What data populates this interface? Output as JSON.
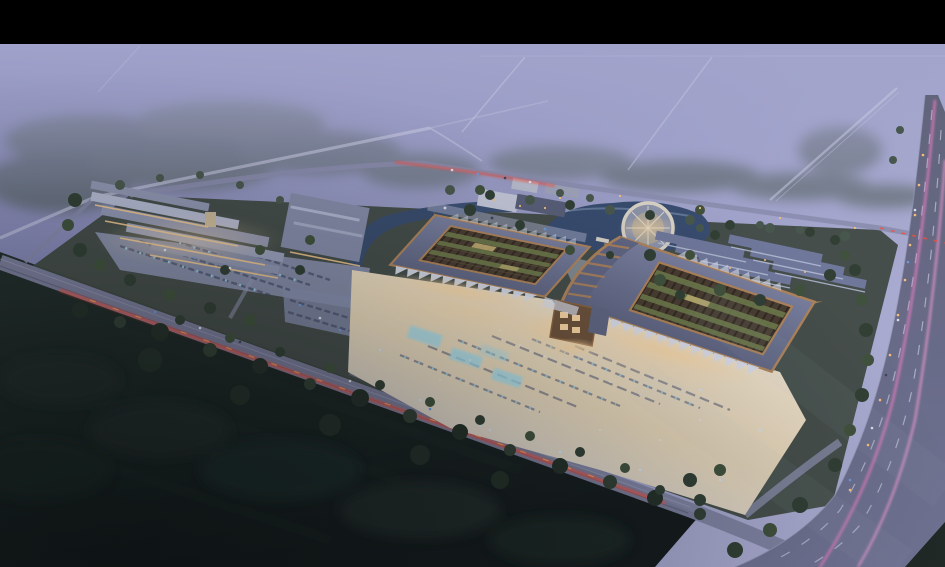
{
  "scene": {
    "type": "aerial-architectural-rendering",
    "time_of_day": "dusk",
    "letterbox_height_px": 44,
    "regions": [
      "letterbox-top",
      "misty-farmland",
      "regional-roads",
      "forest-belt",
      "left-retail-complex",
      "left-parking-lot",
      "canal-and-pond",
      "round-pavilion",
      "lakeside-campus",
      "main-pavilion-west",
      "main-pavilion-east",
      "central-gate-tower",
      "event-plaza",
      "plaza-parking",
      "warehouse-rows",
      "arterial-highway",
      "front-boulevard",
      "dark-farmland",
      "tree-lines"
    ],
    "counts": {
      "main_pavilions": 2,
      "warehouse_rows": 6,
      "left_complex_wings": 5
    },
    "palette": {
      "black": "#000000",
      "mist_left": "#7679a9",
      "mist_mid": "#8f92bc",
      "mist_right": "#abadd2",
      "fog_top": "#a4a6cd",
      "forest": "#3e4d41",
      "field_dark": "#0e1514",
      "field_mid": "#1d2a23",
      "site_green": "#3c463c",
      "road_light": "#9597b4",
      "road_mid": "#7c7f9d",
      "highway": "#686b85",
      "lane_mark": "#c9cce0",
      "red_trail": "#ff4a33",
      "orange_glow": "#ff9a4d",
      "pink_trail": "#f07ec4",
      "pink_trail2": "#ff9fd8",
      "lamp_warm": "#ffc07a",
      "plaza": "#ccd0e2",
      "plaza_warm": "#ead9b8",
      "plaza_bright": "#f7ecd6",
      "cyan_glow": "#9fe0f2",
      "roof_slate": "#5e6480",
      "roof_slate_light": "#777e9c",
      "copper": "#b08355",
      "copper_dark": "#8a6038",
      "trellis": "#46392a",
      "trellis_dark": "#2e2418",
      "garden_green": "#6d7a45",
      "canopy_white": "#dde2ee",
      "glow_warm": "#ffd9a2",
      "left_roof": "#8e95af",
      "left_roof_light": "#b3b9cf",
      "facade_warm": "#f4c98a",
      "row_roof": "#6e7799",
      "row_ridge": "#b9c1d9",
      "pond": "#33496b",
      "pond_light": "#8b9fbe",
      "ring_stone": "#ddd6c6",
      "campus_wall": "#c6c9d8",
      "campus_roof": "#565c74",
      "tower_wall": "#6b4f35"
    }
  }
}
